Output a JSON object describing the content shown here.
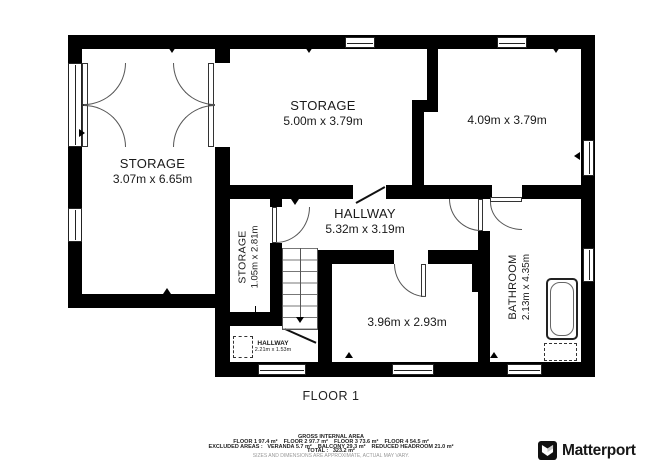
{
  "rooms": {
    "storage_left": {
      "name": "STORAGE",
      "dims": "3.07m x 6.65m"
    },
    "storage_top": {
      "name": "STORAGE",
      "dims": "5.00m x 3.79m"
    },
    "room_top_right": {
      "dims": "4.09m x 3.79m"
    },
    "hallway": {
      "name": "HALLWAY",
      "dims": "5.32m x 3.19m"
    },
    "storage_small": {
      "name": "STORAGE",
      "dims": "1.05m x 2.81m"
    },
    "room_bottom": {
      "dims": "3.96m x 2.93m"
    },
    "bathroom": {
      "name": "BATHROOM",
      "dims": "2.13m x 4.35m"
    },
    "hallway_small": {
      "name": "HALLWAY",
      "dims": "2.21m x 1.53m"
    }
  },
  "floor_label": "FLOOR 1",
  "footer": {
    "title": "GROSS INTERNAL AREA",
    "line_floors": "FLOOR 1 97.4 m²    FLOOR 2 97.7 m²    FLOOR 3 73.6 m²    FLOOR 4 54.5 m²",
    "line_excluded": "EXCLUDED AREAS :   VERANDA 5.7 m²    BALCONY 29.3 m²    REDUCED HEADROOM 21.0 m²",
    "line_total": "TOTAL :   323.2 m²",
    "disclaimer": "SIZES AND DIMENSIONS ARE APPROXIMATE, ACTUAL MAY VARY."
  },
  "brand": {
    "logo": "Matterport"
  },
  "colors": {
    "wall": "#000000",
    "text": "#1a1a1a",
    "disclaimer": "#999999",
    "brand": "#171717"
  }
}
